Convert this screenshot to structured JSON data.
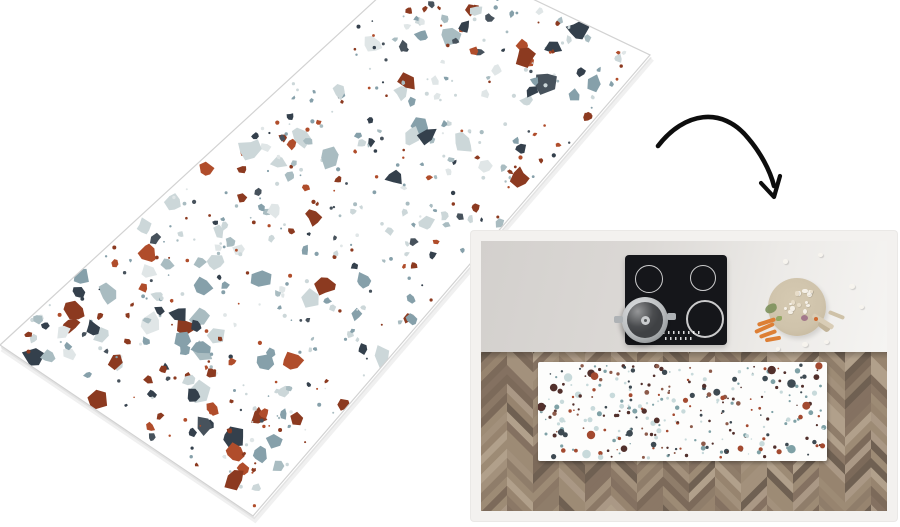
{
  "page": {
    "background_color": "#ffffff"
  },
  "product_mat": {
    "kind": "terrazzo-runner-mat-perspective",
    "base_color": "#ffffff",
    "edge_line_color": "#d2d2d2",
    "speckle_palette": [
      "#34404c",
      "#47525c",
      "#8c3a20",
      "#b04d2b",
      "#86a0aa",
      "#a9bcc1",
      "#ccd7d9",
      "#e0e6e7"
    ],
    "speckle_weights": [
      0.12,
      0.08,
      0.14,
      0.08,
      0.18,
      0.1,
      0.18,
      0.12
    ]
  },
  "arrow": {
    "color": "#0d0d0d"
  },
  "room_photo": {
    "frame_color": "#f3f1ef",
    "frame_edge_color": "#eae8e6",
    "counter_gradient": [
      "#d3d0cd",
      "#dbd8d5",
      "#eceae7",
      "#f5f4f2"
    ],
    "cooktop": {
      "body_color": "#15161a",
      "ring_color": "rgba(255,255,255,0.78)",
      "burner_count": 4,
      "control_dot_color": "rgba(255,255,255,0.85)"
    },
    "pot": {
      "rim_colors": [
        "#e3e5e7",
        "#b9bcbe",
        "#85898c"
      ],
      "lid_color": "#3f4144",
      "knob_color": "#caccce",
      "handle_color": "#aeb2b5"
    },
    "cutting_board": {
      "wood_colors": [
        "#d6cab2",
        "#cfc3ab",
        "#c2b499"
      ],
      "chop_colors": [
        "#f5f0e7",
        "#e8ddc9"
      ],
      "herb_color": "#7d915c",
      "onion_color": "#9b6b85",
      "carrot_color": "#dd7f35",
      "carrot_top_color": "#8aa257",
      "utensil_handle_color": "#d9cdb6"
    },
    "floor": {
      "pattern": "herringbone",
      "base_color": "#8f7d6b",
      "plank_palette": [
        "#8b7866",
        "#97846f",
        "#a3917c",
        "#7c6a5a",
        "#b1a08b",
        "#8f7d6a",
        "#847161",
        "#9d8b75",
        "#6f6052",
        "#aa9885"
      ]
    },
    "floor_mat": {
      "base_color": "#fdfdfc",
      "speckle_palette": [
        "#52302c",
        "#a34a30",
        "#7fa1a6",
        "#c8dadb",
        "#3e4a52",
        "#8c5a4a"
      ],
      "speckle_weights": [
        0.22,
        0.16,
        0.2,
        0.2,
        0.14,
        0.08
      ]
    }
  }
}
